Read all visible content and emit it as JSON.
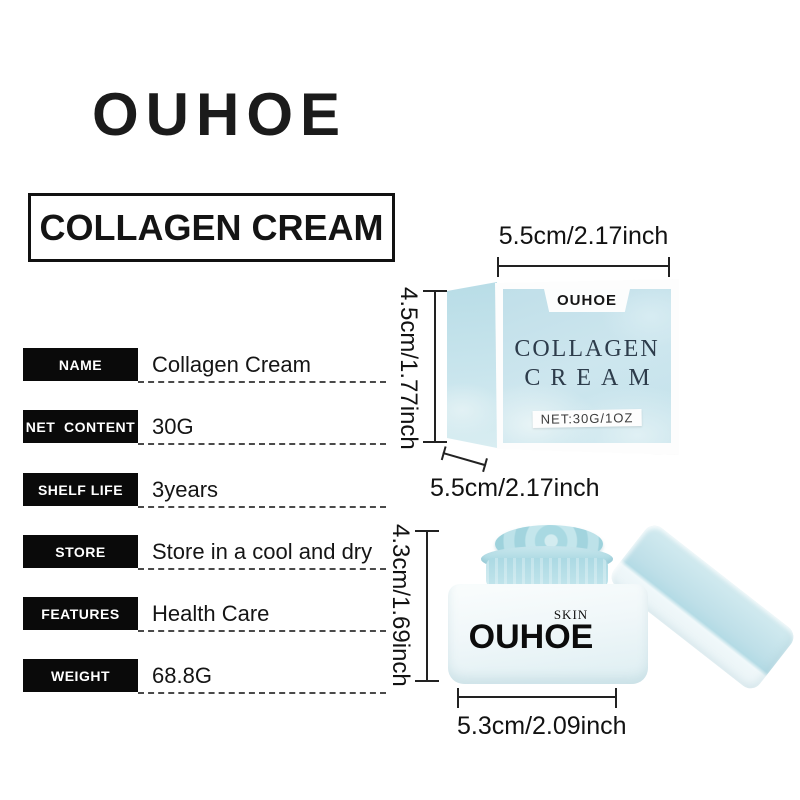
{
  "brand": {
    "logo": "OUHOE"
  },
  "title": "COLLAGEN CREAM",
  "specs": [
    {
      "label": "NAME",
      "value": "Collagen Cream"
    },
    {
      "label": "NET  CONTENT",
      "value": "30G"
    },
    {
      "label": "SHELF LIFE",
      "value": "3years"
    },
    {
      "label": "STORE",
      "value": "Store in a cool and dry"
    },
    {
      "label": "FEATURES",
      "value": "Health Care"
    },
    {
      "label": "WEIGHT",
      "value": "68.8G"
    }
  ],
  "box_figure": {
    "width_label": "5.5cm/2.17inch",
    "height_label": "4.5cm/1.77inch",
    "depth_label": "5.5cm/2.17inch",
    "brand": "OUHOE",
    "line1": "COLLAGEN",
    "line2": "CREAM",
    "net": "NET:30G/1OZ"
  },
  "jar_figure": {
    "height_label": "4.3cm/1.69inch",
    "width_label": "5.3cm/2.09inch",
    "skin": "SKIN",
    "brand": "OUHOE"
  },
  "colors": {
    "label_black": "#0a0a0a",
    "box_blue": "#c3e1ea",
    "box_highlight": "#e8f4f6",
    "navy_text": "#2d3c4b",
    "jar_body": "#eef6f8",
    "cream_blue": "#a7d8e1",
    "lid_blue": "#bedfe8"
  }
}
